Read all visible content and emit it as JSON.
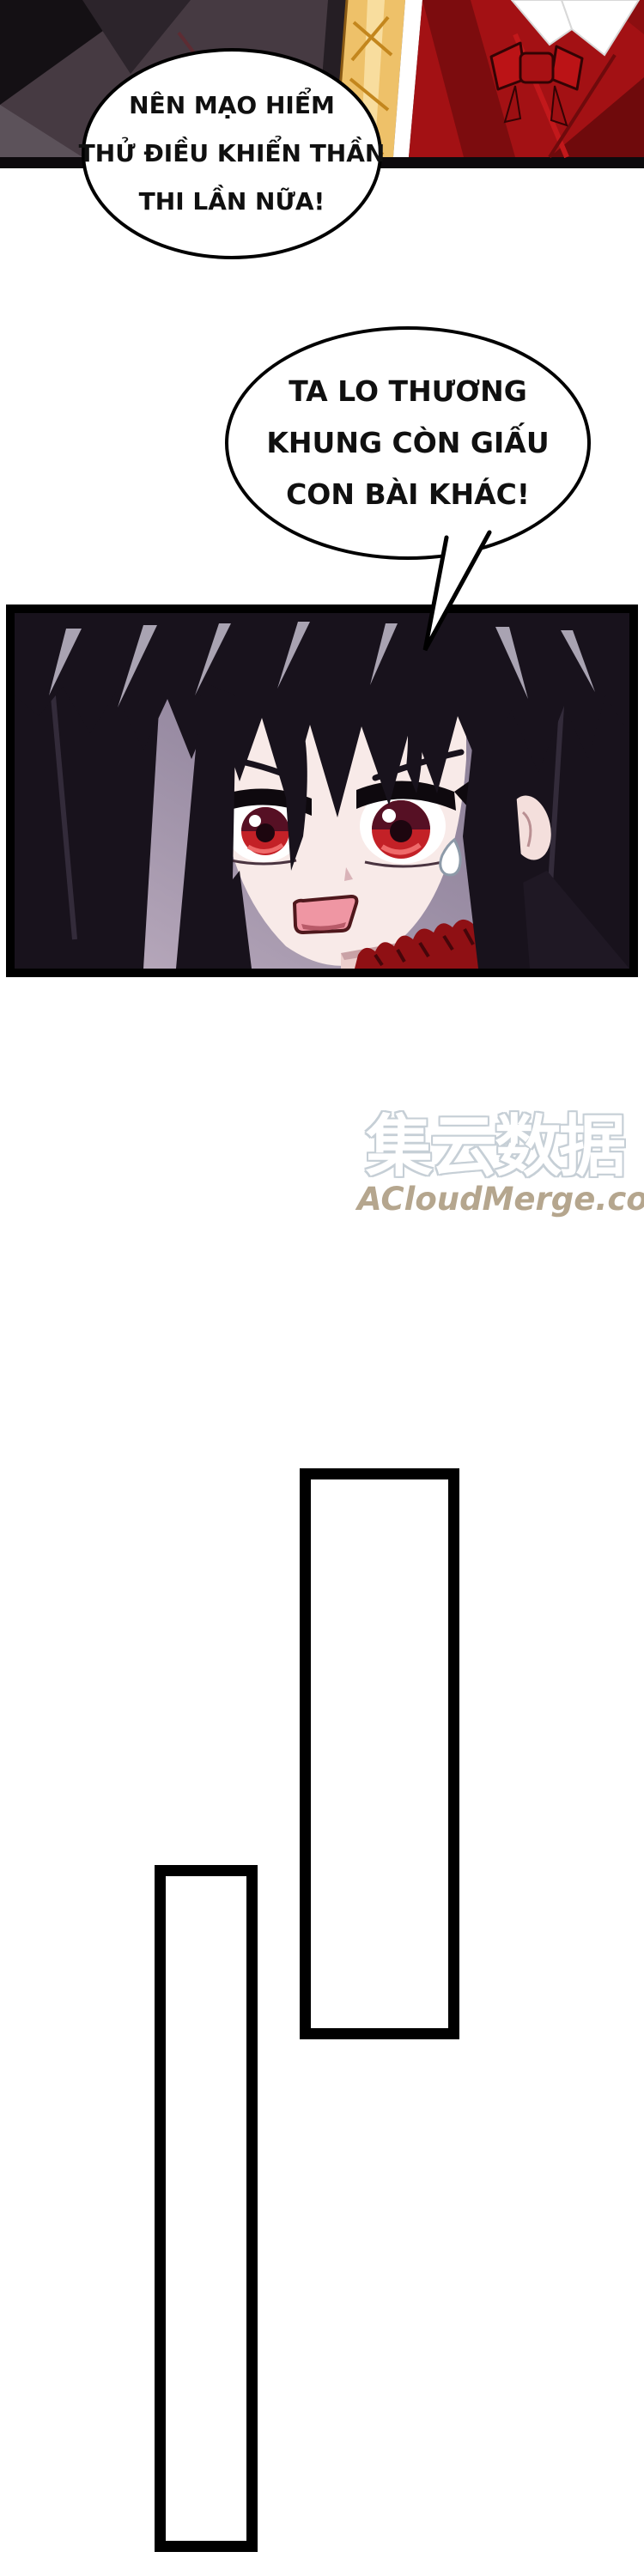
{
  "bubbles": {
    "bubble1": {
      "lines": [
        "NÊN MẠO HIỂM",
        "THỬ ĐIỀU KHIỂN THẦN",
        "THI LẦN NỮA!"
      ]
    },
    "bubble2": {
      "lines": [
        "TA LO THƯƠNG",
        "KHUNG CÒN GIẤU",
        "CON BÀI KHÁC!"
      ]
    }
  },
  "watermark": {
    "logo_text": "集云数据",
    "site_text": "ACloudMerge.com",
    "logo_outline_color": "#c6cfd6",
    "site_color": "#b5a68e"
  },
  "colors": {
    "panel_border": "#000000",
    "page_background": "#ffffff",
    "dark_figure": "#463a42",
    "gold_garment": "#eec169",
    "red_garment": "#a31114",
    "girl_background_top": "#7e7289",
    "girl_background_bottom": "#bdaec0",
    "girl_hair": "#18121c",
    "girl_skin": "#f8eae8",
    "eye_red": "#c32127",
    "choker_red": "#8f1014"
  }
}
